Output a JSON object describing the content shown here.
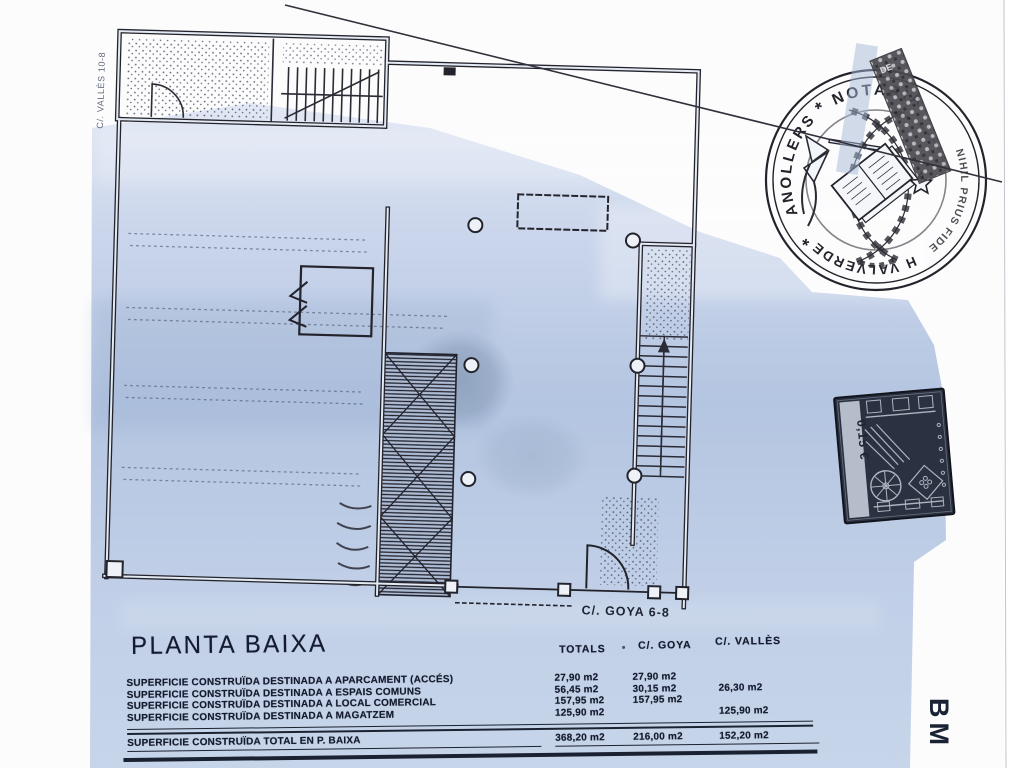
{
  "plan": {
    "street_goya": "C/. GOYA 6-8",
    "street_valles": "C/. VALLÈS 10-8"
  },
  "notary_stamp": {
    "top": "NOTARIA",
    "left": "GRANOLLERS",
    "motto": "NIHIL PRIUS FIDE",
    "bottom": "H VALVERDE",
    "separator": "*",
    "band": "DE"
  },
  "fiscal_stamp": {
    "value": "0,15 €"
  },
  "side_label": "BM",
  "table": {
    "title": "PLANTA BAIXA",
    "columns": [
      "TOTALS",
      "C/. GOYA",
      "C/. VALLÈS"
    ],
    "rows": [
      {
        "label": "SUPERFICIE CONSTRUÏDA DESTINADA A APARCAMENT (ACCÉS)",
        "totals": "27,90 m2",
        "goya": "27,90 m2",
        "valles": ""
      },
      {
        "label": "SUPERFICIE CONSTRUÏDA DESTINADA A ESPAIS COMUNS",
        "totals": "56,45 m2",
        "goya": "30,15 m2",
        "valles": "26,30 m2"
      },
      {
        "label": "SUPERFICIE CONSTRUÏDA DESTINADA A LOCAL COMERCIAL",
        "totals": "157,95 m2",
        "goya": "157,95 m2",
        "valles": ""
      },
      {
        "label": "SUPERFICIE CONSTRUÏDA DESTINADA A MAGATZEM",
        "totals": "125,90 m2",
        "goya": "",
        "valles": "125,90 m2"
      }
    ],
    "total": {
      "label": "SUPERFICIE CONSTRUÏDA TOTAL EN P. BAIXA",
      "totals": "368,20 m2",
      "goya": "216,00 m2",
      "valles": "152,20 m2"
    }
  },
  "colors": {
    "paper_blue": "#b9c9e2",
    "ink": "#23232c",
    "fiscal_stamp_dark": "#2b3140"
  }
}
